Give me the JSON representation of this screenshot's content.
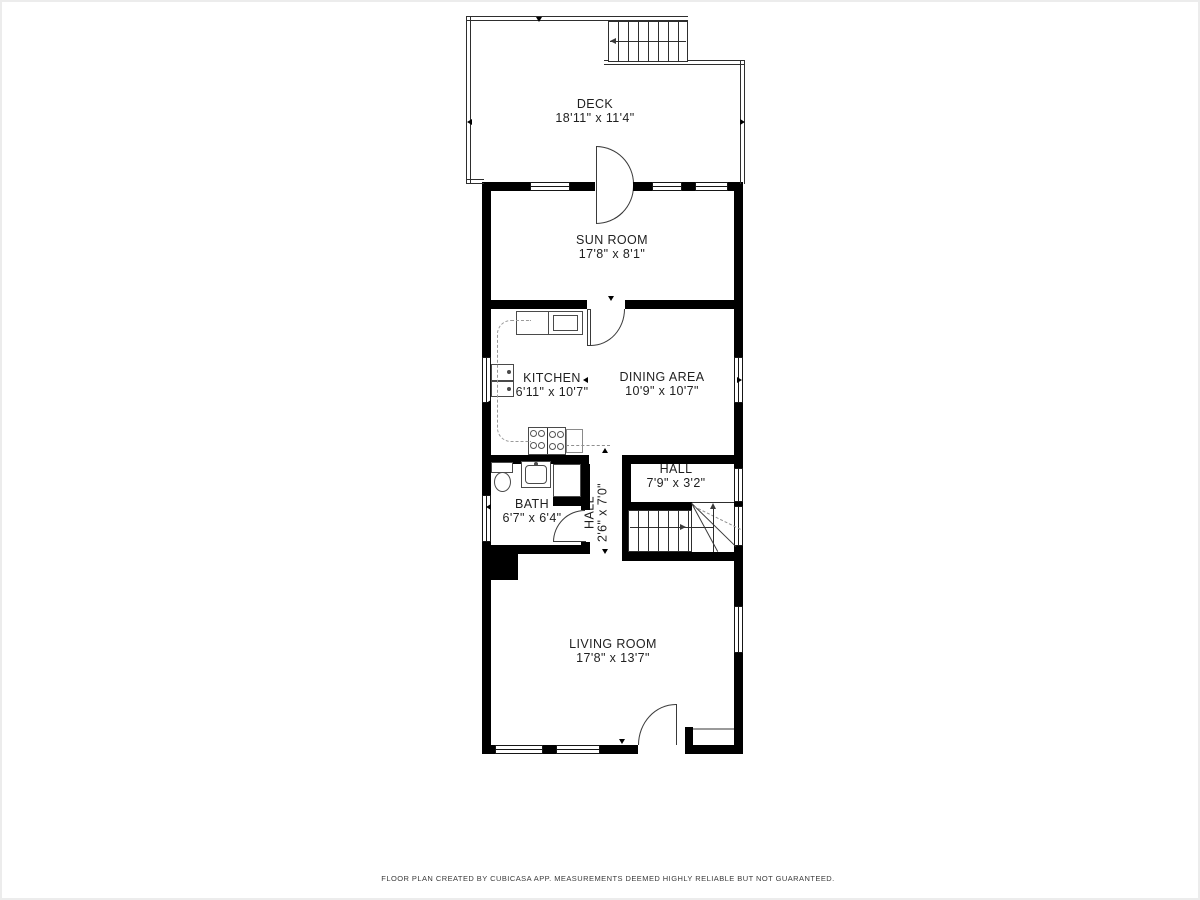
{
  "rooms": {
    "deck": {
      "name": "DECK",
      "dims": "18'11\" x 11'4\""
    },
    "sun_room": {
      "name": "SUN ROOM",
      "dims": "17'8\" x 8'1\""
    },
    "kitchen": {
      "name": "KITCHEN",
      "dims": "6'11\" x 10'7\""
    },
    "dining_area": {
      "name": "DINING AREA",
      "dims": "10'9\" x 10'7\""
    },
    "hall_upper": {
      "name": "HALL",
      "dims": "7'9\" x 3'2\""
    },
    "bath": {
      "name": "BATH",
      "dims": "6'7\" x 6'4\""
    },
    "hall_corridor": {
      "name": "HALL",
      "dims": "2'6\" x 7'0\""
    },
    "living_room": {
      "name": "LIVING ROOM",
      "dims": "17'8\" x 13'7\""
    }
  },
  "footer": {
    "disclaimer": "FLOOR PLAN CREATED BY CUBICASA APP. MEASUREMENTS DEEMED HIGHLY RELIABLE BUT NOT GUARANTEED."
  },
  "colors": {
    "wall": "#000000",
    "line": "#3a3a3a",
    "fixture": "#4a4a4a",
    "text": "#1f1f1f",
    "background": "#ffffff"
  }
}
